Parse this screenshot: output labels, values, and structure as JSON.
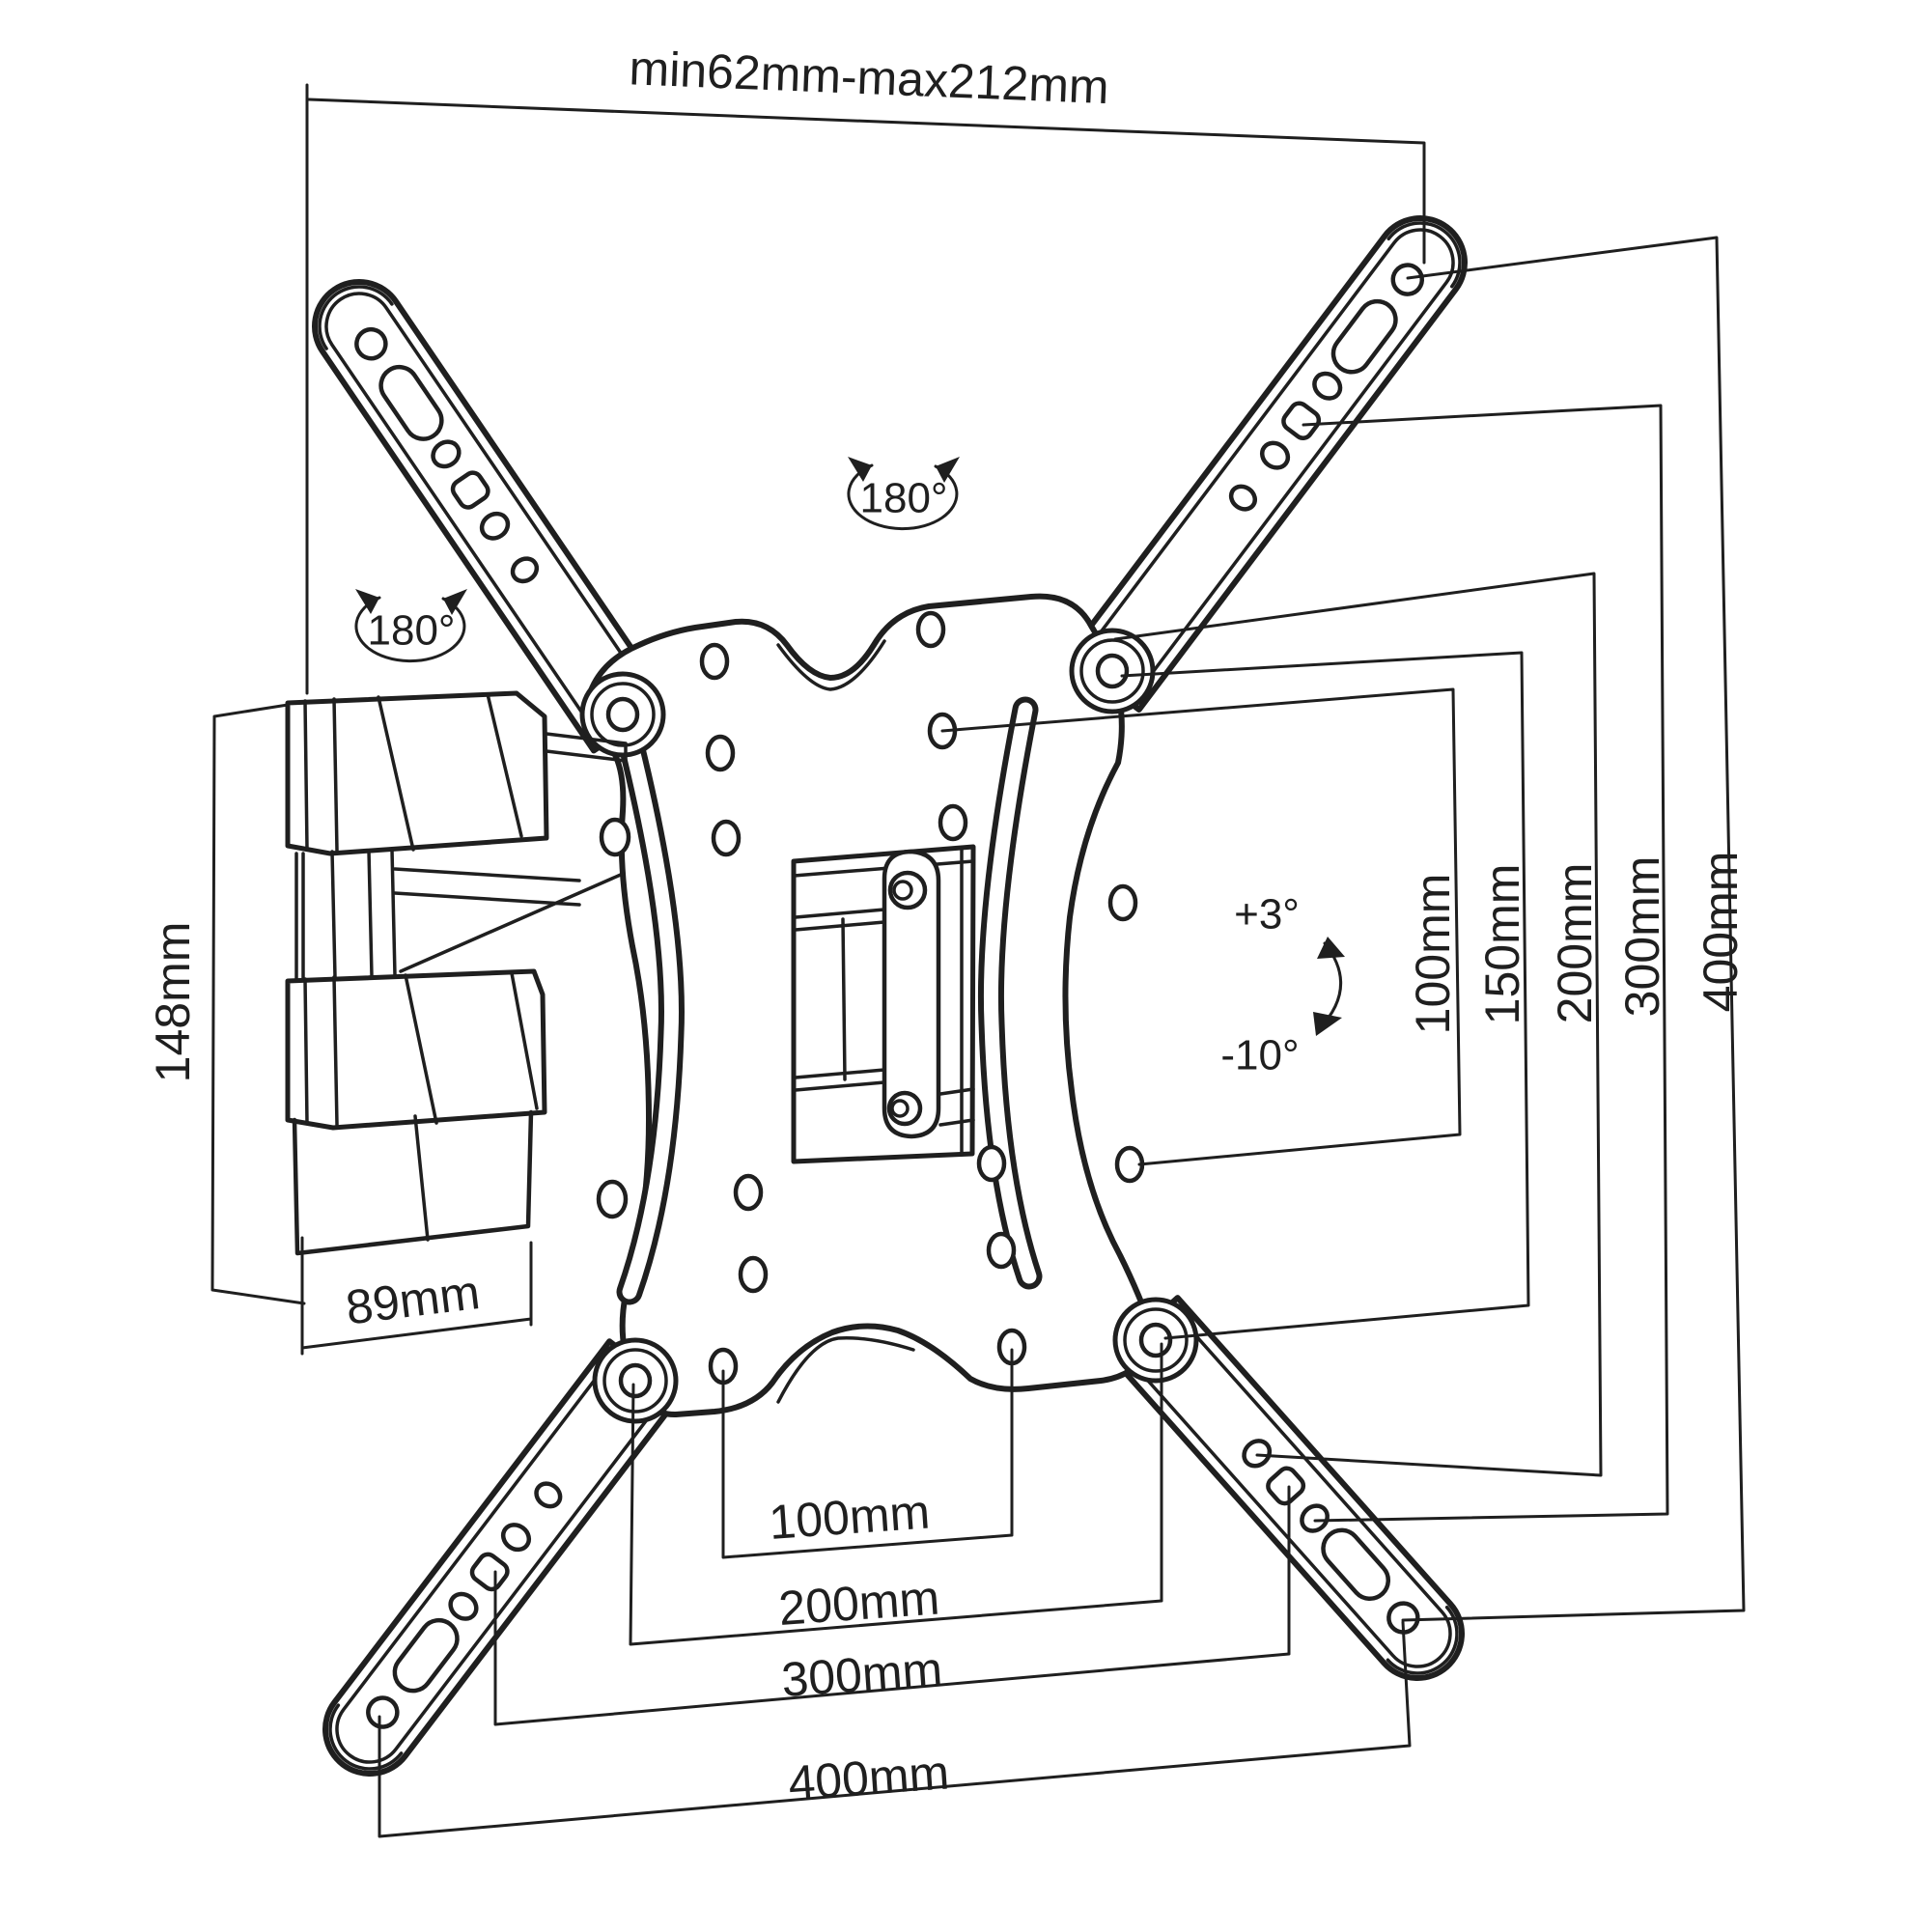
{
  "diagram_title": "TV wall mount bracket technical drawing",
  "labels": {
    "top_width": "min62mm-max212mm",
    "rotation_top": "180°",
    "rotation_left": "180°",
    "tilt_up": "+3°",
    "tilt_down": "-10°",
    "arm_height": "148mm",
    "arm_depth": "89mm",
    "vesa_vertical": [
      "100mm",
      "150mm",
      "200mm",
      "300mm",
      "400mm"
    ],
    "vesa_horizontal": [
      "100mm",
      "200mm",
      "300mm",
      "400mm"
    ]
  },
  "colors": {
    "line": "#1f1f1f",
    "background": "#ffffff"
  }
}
